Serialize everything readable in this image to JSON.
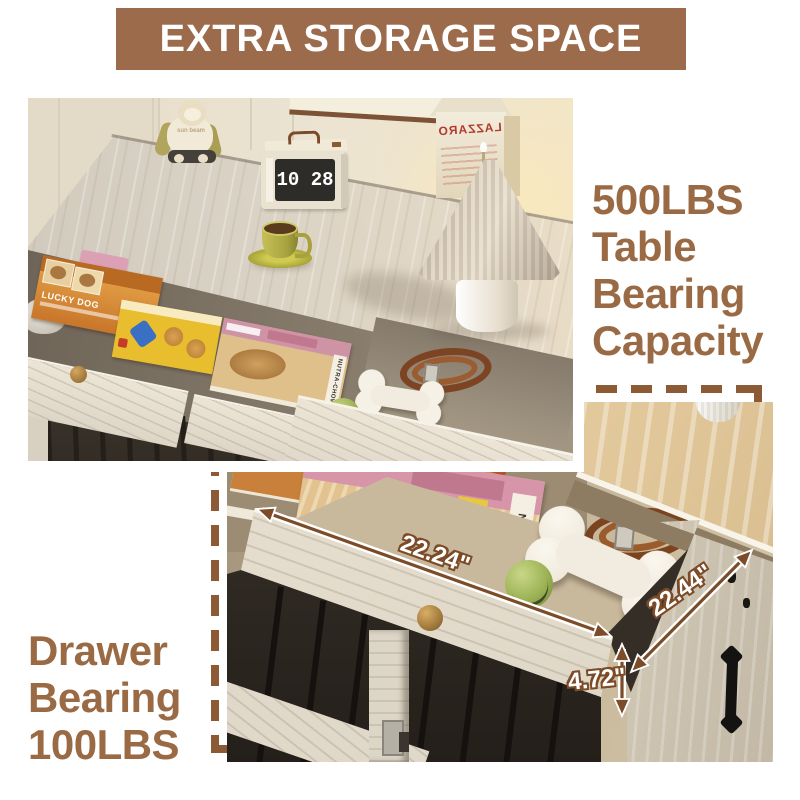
{
  "banner": {
    "title": "EXTRA STORAGE SPACE"
  },
  "callouts": {
    "table": {
      "line1": "500LBS",
      "line2": "Table",
      "line3": "Bearing",
      "line4": "Capacity"
    },
    "drawer": {
      "line1": "Drawer",
      "line2": "Bearing",
      "line3": "100LBS"
    }
  },
  "dimensions": {
    "drawer_width": "22.24\"",
    "drawer_depth": "22.44\"",
    "drawer_height": "4.72\""
  },
  "scene": {
    "clock_time": "10 28",
    "plush_text": "sun beam",
    "carton_text": "LAZZARO",
    "dog_food_box": "LUCKY DOG",
    "magazine_spine": "NUTRA-CHOW"
  },
  "colors": {
    "banner_bg": "#9C6B4C",
    "callout_text": "#9A6A45",
    "dash": "#8C5B36",
    "arrow": "#7C4B27"
  }
}
